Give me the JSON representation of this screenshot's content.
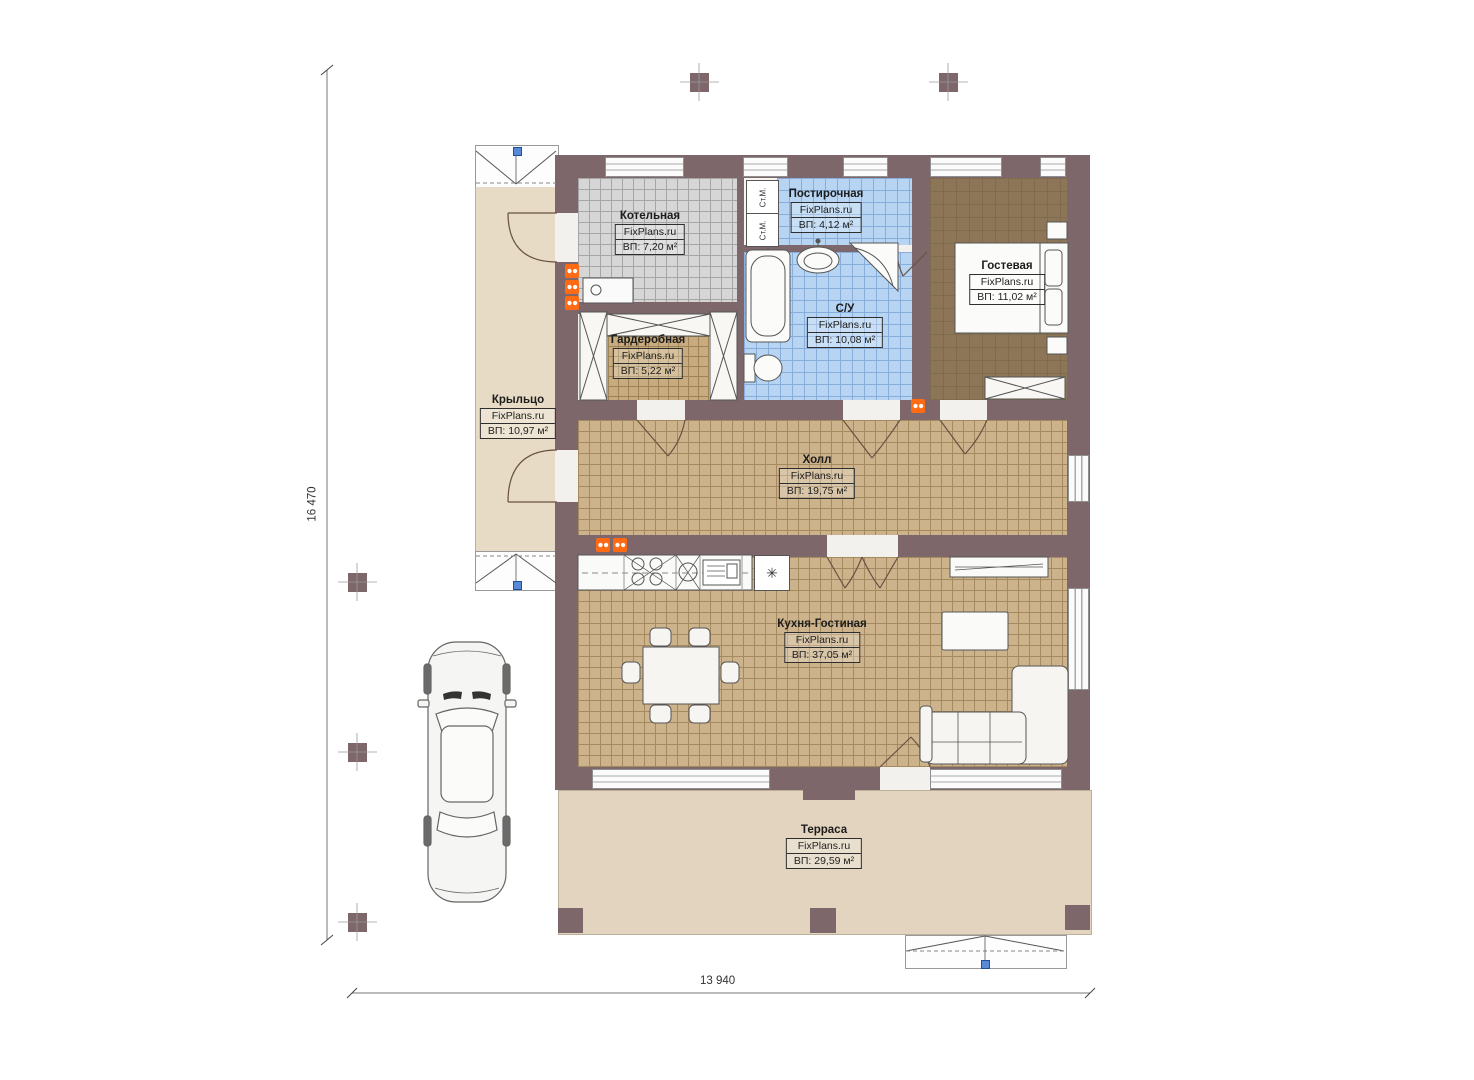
{
  "plan": {
    "brand": "FixPlans.ru",
    "dimensions": {
      "height_label": "16 470",
      "width_label": "13 940"
    },
    "rooms": {
      "boiler": {
        "name": "Котельная",
        "brand": "FixPlans.ru",
        "area": "ВП: 7,20 м²"
      },
      "laundry": {
        "name": "Постирочная",
        "brand": "FixPlans.ru",
        "area": "ВП: 4,12 м²"
      },
      "guest": {
        "name": "Гостевая",
        "brand": "FixPlans.ru",
        "area": "ВП: 11,02 м²"
      },
      "bathroom": {
        "name": "С/У",
        "brand": "FixPlans.ru",
        "area": "ВП: 10,08 м²"
      },
      "wardrobe": {
        "name": "Гардеробная",
        "brand": "FixPlans.ru",
        "area": "ВП: 5,22 м²"
      },
      "porch": {
        "name": "Крыльцо",
        "brand": "FixPlans.ru",
        "area": "ВП: 10,97 м²"
      },
      "hall": {
        "name": "Холл",
        "brand": "FixPlans.ru",
        "area": "ВП: 19,75 м²"
      },
      "kitchen_living": {
        "name": "Кухня-Гостиная",
        "brand": "FixPlans.ru",
        "area": "ВП: 37,05 м²"
      },
      "terrace": {
        "name": "Терраса",
        "brand": "FixPlans.ru",
        "area": "ВП: 29,59 м²"
      }
    },
    "appliances": {
      "washer_label": "Ст.М."
    },
    "icons": {
      "fridge_snowflake": "✳"
    },
    "colors": {
      "wall": "#7d676a",
      "floor_tan": "#cdb38b",
      "floor_gray": "#d6d6d6",
      "floor_blue": "#b7d5f2",
      "floor_guest": "#8d7557",
      "porch_beige": "#e7dbc5",
      "terrace_beige": "#e2d4be",
      "socket_orange": "#ff6b15",
      "handle_blue": "#5a8ad6"
    }
  }
}
